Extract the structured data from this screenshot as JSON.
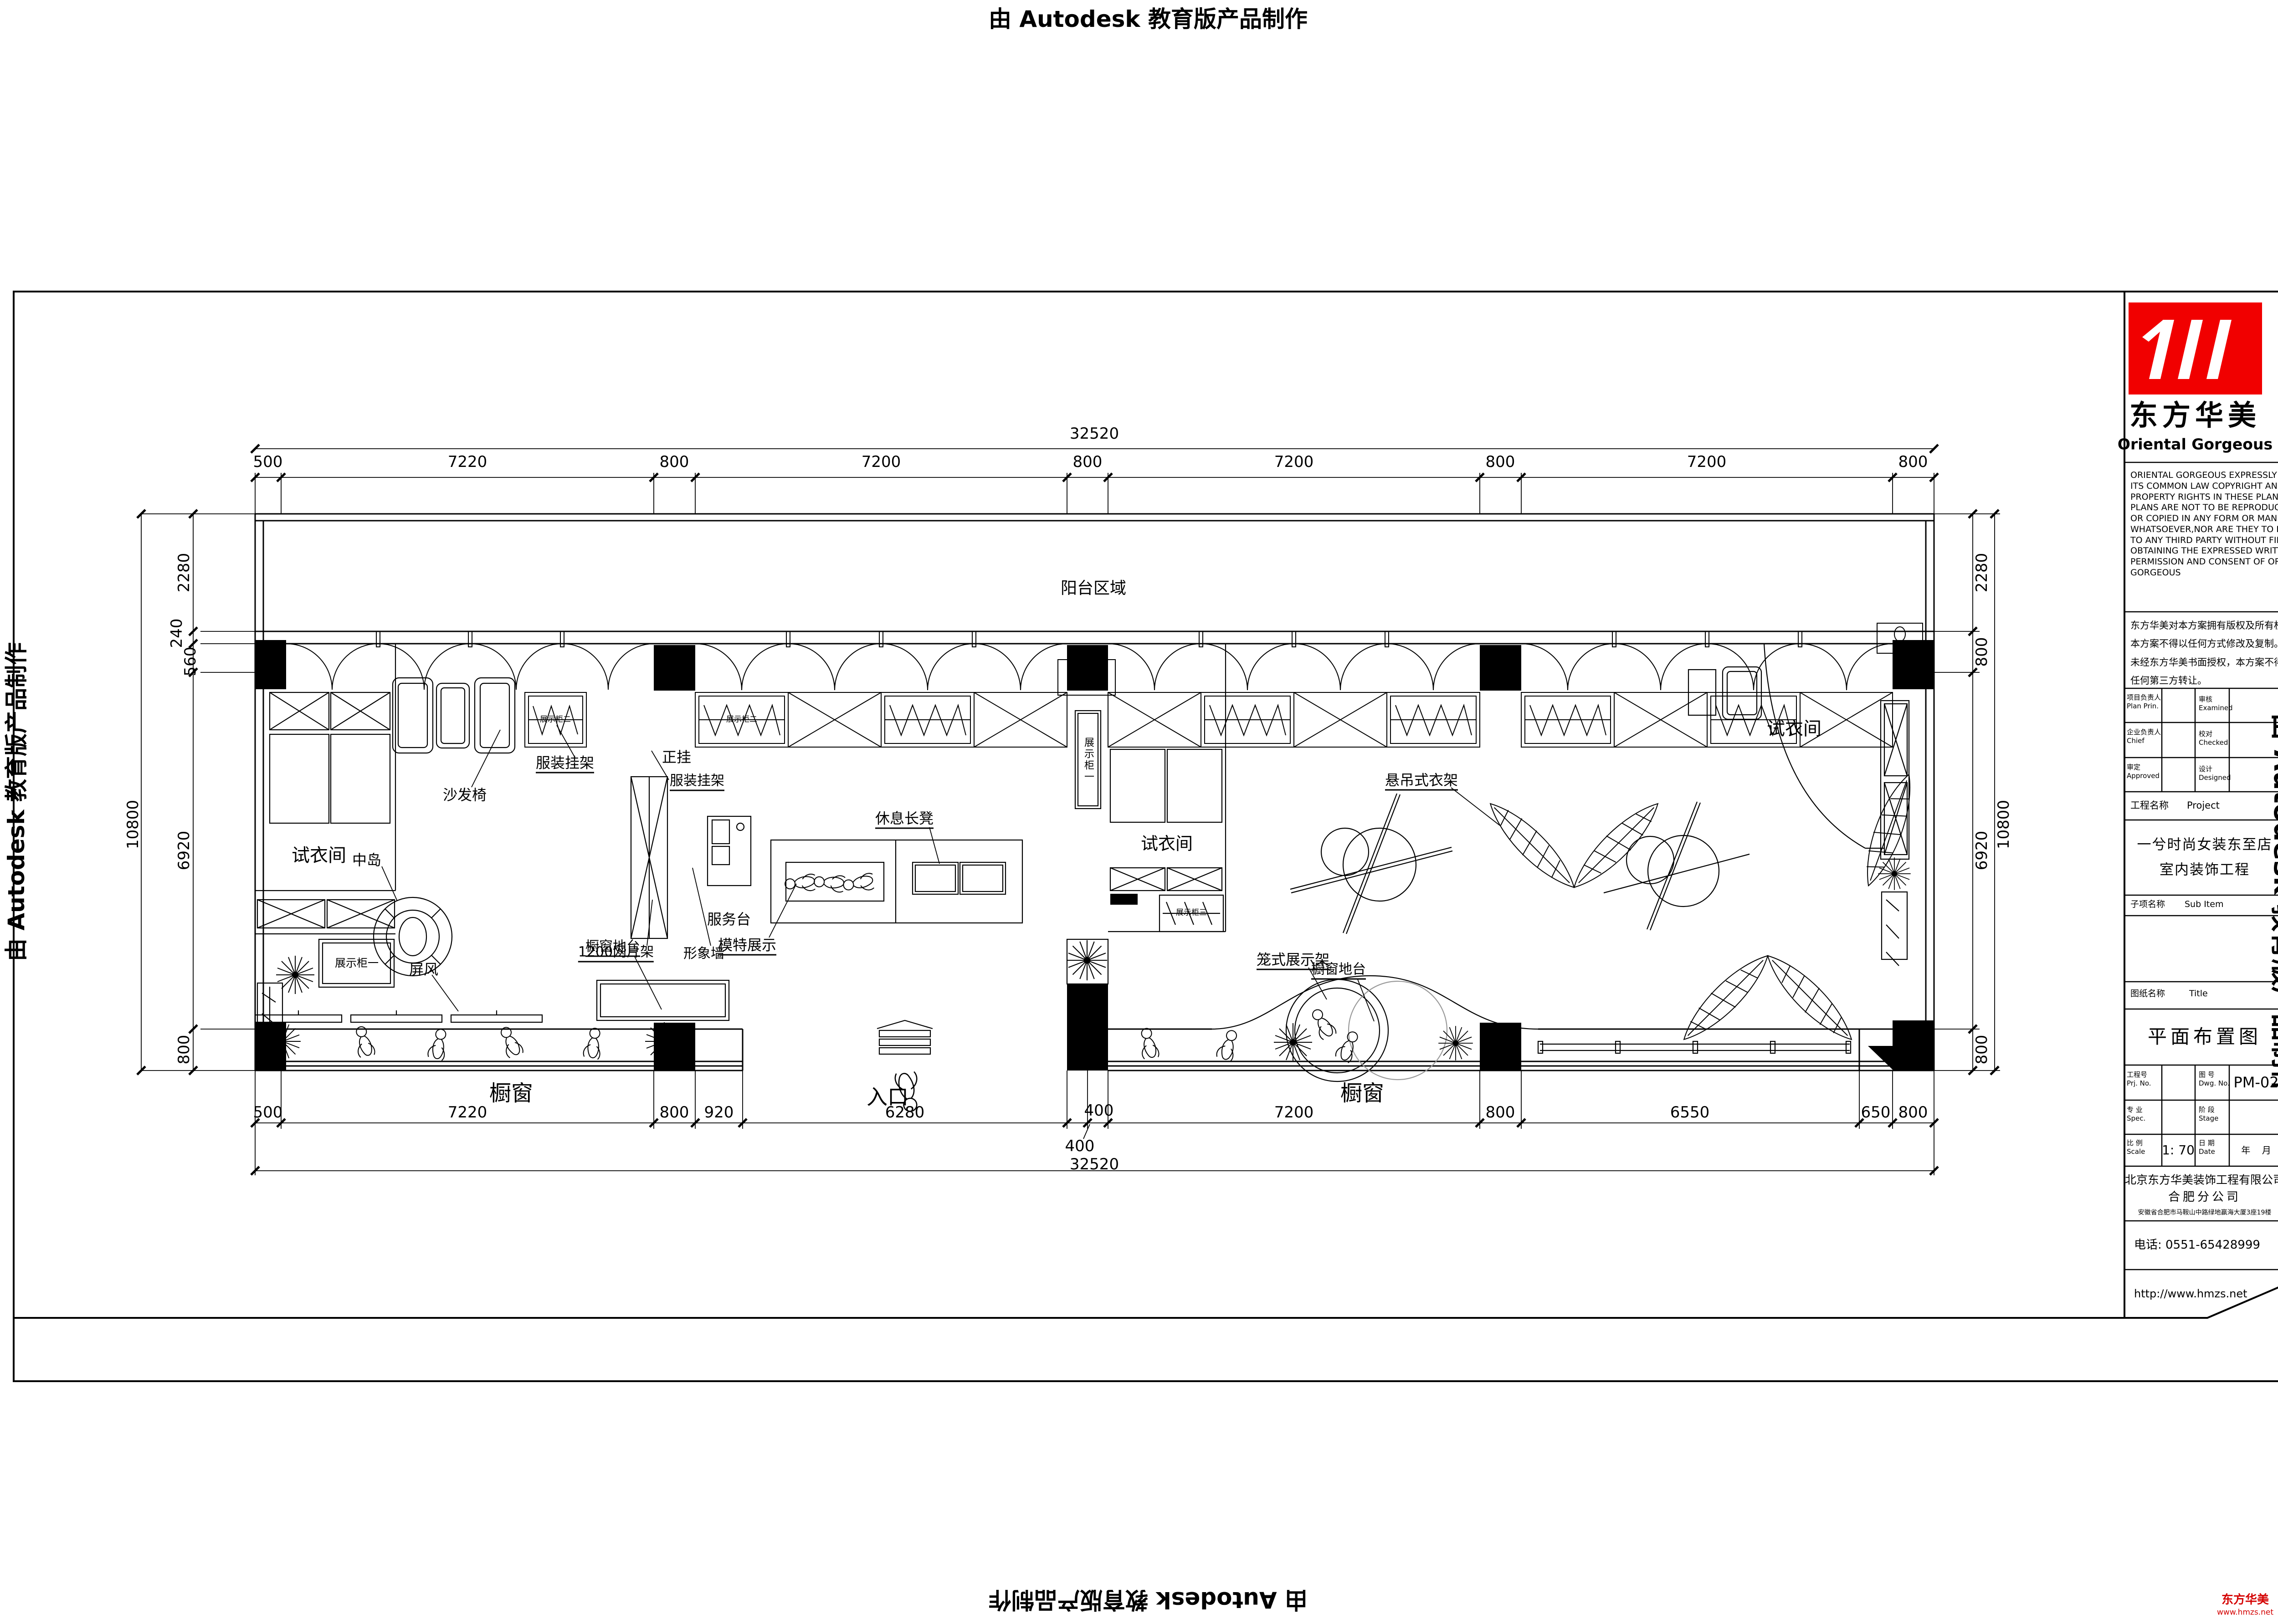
{
  "stamp": {
    "text": "由 Autodesk 教育版产品制作"
  },
  "watermark": {
    "brand": "东方华美",
    "site": "www.hmzs.net"
  },
  "title_block": {
    "logo": {
      "cn": "东方华美",
      "en": "Oriental  Gorgeous"
    },
    "copyright_en": [
      "ORIENTAL GORGEOUS EXPRESSLY RESERVES",
      "ITS COMMON LAW COPYRIGHT AND OTHER",
      "PROPERTY RIGHTS IN THESE PLANS,THESE",
      "PLANS ARE NOT TO BE REPRODUCED CHANGED",
      "OR COPIED IN ANY FORM OR MANNER",
      "WHATSOEVER,NOR ARE THEY TO BE ASSIGNED",
      "TO ANY THIRD PARTY WITHOUT FIRST",
      "OBTAINING THE EXPRESSED WRITTEN",
      "PERMISSION AND CONSENT OF ORIENTAL",
      "GORGEOUS"
    ],
    "copyright_cn": [
      "东方华美对本方案拥有版权及所有权。",
      "本方案不得以任何方式修改及复制。",
      "未经东方华美书面授权，本方案不得向",
      "任何第三方转让。"
    ],
    "fields": {
      "plan_prin_cn": "项目负责人",
      "plan_prin_en": "Plan Prin.",
      "examined_cn": "审核",
      "examined_en": "Examined",
      "chief_cn": "企业负责人",
      "chief_en": "Chief",
      "checked_cn": "校对",
      "checked_en": "Checked",
      "approved_cn": "审定",
      "approved_en": "Approved",
      "designed_cn": "设计",
      "designed_en": "Designed"
    },
    "project_label_cn": "工程名称",
    "project_label_en": "Project",
    "project_name_1": "一兮时尚女装东至店",
    "project_name_2": "室内装饰工程",
    "subitem_cn": "子项名称",
    "subitem_en": "Sub Item",
    "sheet_label_cn": "图纸名称",
    "sheet_label_en": "Title",
    "sheet_title": "平面布置图",
    "prj_no_cn": "工程号",
    "prj_no_en": "Prj. No.",
    "dwg_no_cn": "图 号",
    "dwg_no_en": "Dwg. No.",
    "dwg_no": "PM-02",
    "spec_cn": "专 业",
    "spec_en": "Spec.",
    "stage_cn": "阶 段",
    "stage_en": "Stage",
    "scale_cn": "比 例",
    "scale_en": "Scale",
    "scale": "1: 70",
    "date_cn": "日 期",
    "date_en": "Date",
    "date": "年    月",
    "company_1": "北京东方华美装饰工程有限公司",
    "company_2": "合肥分公司",
    "address": "安徽省合肥市马鞍山中路绿地赢海大厦3座19楼",
    "phone": "电话: 0551-65428999",
    "website": "http://www.hmzs.net"
  },
  "plan": {
    "labels": {
      "balcony": "阳台区域",
      "fitting_left": "试衣间",
      "fitting_mid": "试衣间",
      "fitting_right": "试衣间",
      "sofa_chair": "沙发椅",
      "rack_left": "服装挂架",
      "front_hang": "正挂",
      "rack_right": "服装挂架",
      "bench": "休息长凳",
      "mannequin_display": "模特展示",
      "island": "中岛",
      "mesh_rack": "1200网片架",
      "image_wall": "形象墙",
      "service_desk": "服务台",
      "screen": "屏风",
      "platform_left": "橱窗地台",
      "platform_right": "橱窗地台",
      "window_left": "橱窗",
      "window_right": "橱窗",
      "entrance": "入口",
      "hanging_rack": "悬吊式衣架",
      "cage_rack": "笼式展示架",
      "cabinet_1": "展示柜一",
      "cabinet_1b": "展示柜一",
      "cabinet_2a": "展示柜二",
      "cabinet_2b": "展示柜二",
      "cabinet_3": "展示柜三"
    },
    "scale_note": "1: 70"
  },
  "dims": {
    "top_overall": "32520",
    "bottom_overall": "32520",
    "left_overall": "10800",
    "right_overall": "10800",
    "top": [
      "500",
      "7220",
      "800",
      "7200",
      "800",
      "7200",
      "800",
      "7200",
      "800"
    ],
    "bottom": [
      "500",
      "7220",
      "800",
      "920",
      "6280",
      "400",
      "400",
      "7200",
      "800",
      "6550",
      "650",
      "800"
    ],
    "left": [
      "2280",
      "240",
      "560",
      "6920",
      "800"
    ],
    "right": [
      "2280",
      "800",
      "6920",
      "800"
    ]
  }
}
